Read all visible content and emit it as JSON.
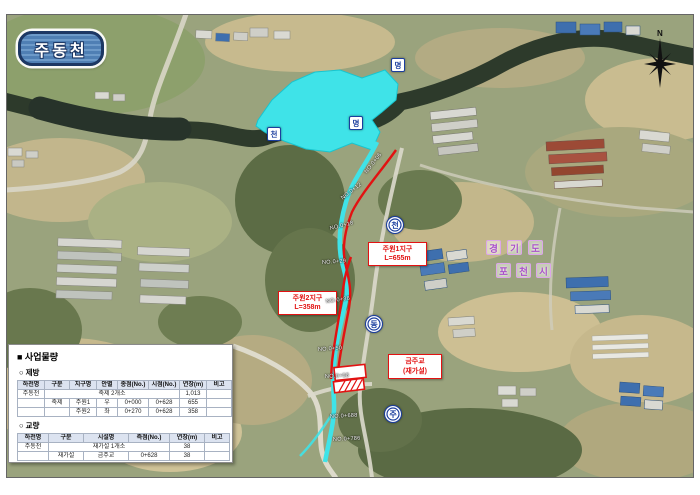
{
  "title_badge": "주동천",
  "compass": {
    "north_label": "N"
  },
  "map_labels": {
    "district1": {
      "line1": "주원1지구",
      "line2": "L=655m"
    },
    "district2": {
      "line1": "주원2지구",
      "line2": "L=358m"
    },
    "bridge": {
      "line1": "금주교",
      "line2": "(재가설)"
    },
    "region": {
      "line1": "경기도",
      "line2": "포천시"
    },
    "stream_badges": [
      {
        "ch": "명",
        "x": 391,
        "y": 58,
        "shape": "square"
      },
      {
        "ch": "명",
        "x": 349,
        "y": 116,
        "shape": "square"
      },
      {
        "ch": "천",
        "x": 267,
        "y": 127,
        "shape": "square"
      },
      {
        "ch": "천",
        "x": 386,
        "y": 216,
        "shape": "circle"
      },
      {
        "ch": "동",
        "x": 365,
        "y": 315,
        "shape": "circle"
      },
      {
        "ch": "주",
        "x": 384,
        "y": 405,
        "shape": "circle"
      }
    ],
    "stations": [
      {
        "t": "NO.0+06",
        "x": 366,
        "y": 170,
        "r": -52
      },
      {
        "t": "NO.0+12",
        "x": 342,
        "y": 196,
        "r": -38
      },
      {
        "t": "NO.0+18",
        "x": 330,
        "y": 226,
        "r": -14
      },
      {
        "t": "NO.0+29",
        "x": 322,
        "y": 260,
        "r": -4
      },
      {
        "t": "NO.0+36",
        "x": 326,
        "y": 299,
        "r": -8
      },
      {
        "t": "NO.0+50",
        "x": 318,
        "y": 347,
        "r": -4
      },
      {
        "t": "NO.0+58",
        "x": 325,
        "y": 374,
        "r": -3
      },
      {
        "t": "NO.0+688",
        "x": 330,
        "y": 414,
        "r": -3
      },
      {
        "t": "NO.0+786",
        "x": 333,
        "y": 437,
        "r": -3
      }
    ]
  },
  "panel": {
    "title": "■ 사업물량",
    "section1": "○ 제방",
    "table1": {
      "headers": [
        "하천명",
        "구분",
        "지구명",
        "안별",
        "종점(No.)",
        "시점(No.)",
        "연장(m)",
        "비고"
      ],
      "rows": [
        [
          {
            "t": "주동천"
          },
          {
            "t": "축제 2개소",
            "cs": 5
          },
          {
            "t": "1,013"
          },
          {
            "t": ""
          }
        ],
        [
          {
            "t": ""
          },
          {
            "t": "축제"
          },
          {
            "t": "주원1"
          },
          {
            "t": "우"
          },
          {
            "t": "0+000"
          },
          {
            "t": "0+628"
          },
          {
            "t": "655"
          },
          {
            "t": ""
          }
        ],
        [
          {
            "t": ""
          },
          {
            "t": ""
          },
          {
            "t": "주원2"
          },
          {
            "t": "좌"
          },
          {
            "t": "0+270"
          },
          {
            "t": "0+628"
          },
          {
            "t": "358"
          },
          {
            "t": ""
          }
        ]
      ]
    },
    "section2": "○ 교량",
    "table2": {
      "headers": [
        "하천명",
        "구분",
        "시설명",
        "측점(No.)",
        "연장(m)",
        "비고"
      ],
      "rows": [
        [
          {
            "t": "주동천"
          },
          {
            "t": "재가설 1개소",
            "cs": 3
          },
          {
            "t": "38"
          },
          {
            "t": ""
          }
        ],
        [
          {
            "t": ""
          },
          {
            "t": "재가설"
          },
          {
            "t": "금주교"
          },
          {
            "t": "0+628"
          },
          {
            "t": "38"
          },
          {
            "t": ""
          }
        ]
      ]
    }
  }
}
